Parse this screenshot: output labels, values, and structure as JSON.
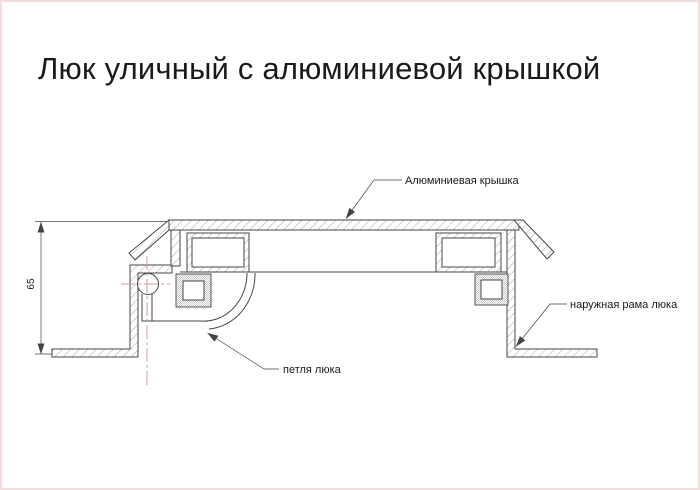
{
  "window": {
    "title": "Люк уличный с алюминиевой крышкой"
  },
  "drawing": {
    "callouts": {
      "cover_label": "Алюминиевая крышка",
      "frame_label": "наружная рама люка",
      "hinge_label": "петля люка"
    },
    "dimensions": {
      "height_65": "65"
    },
    "colors": {
      "line": "#444444",
      "hatch": "#8f8f8f",
      "stipple": "#c8c8c8",
      "centerline": "#cc9c94",
      "page_border": "#f1dddc",
      "text": "#1a1a1a"
    }
  }
}
